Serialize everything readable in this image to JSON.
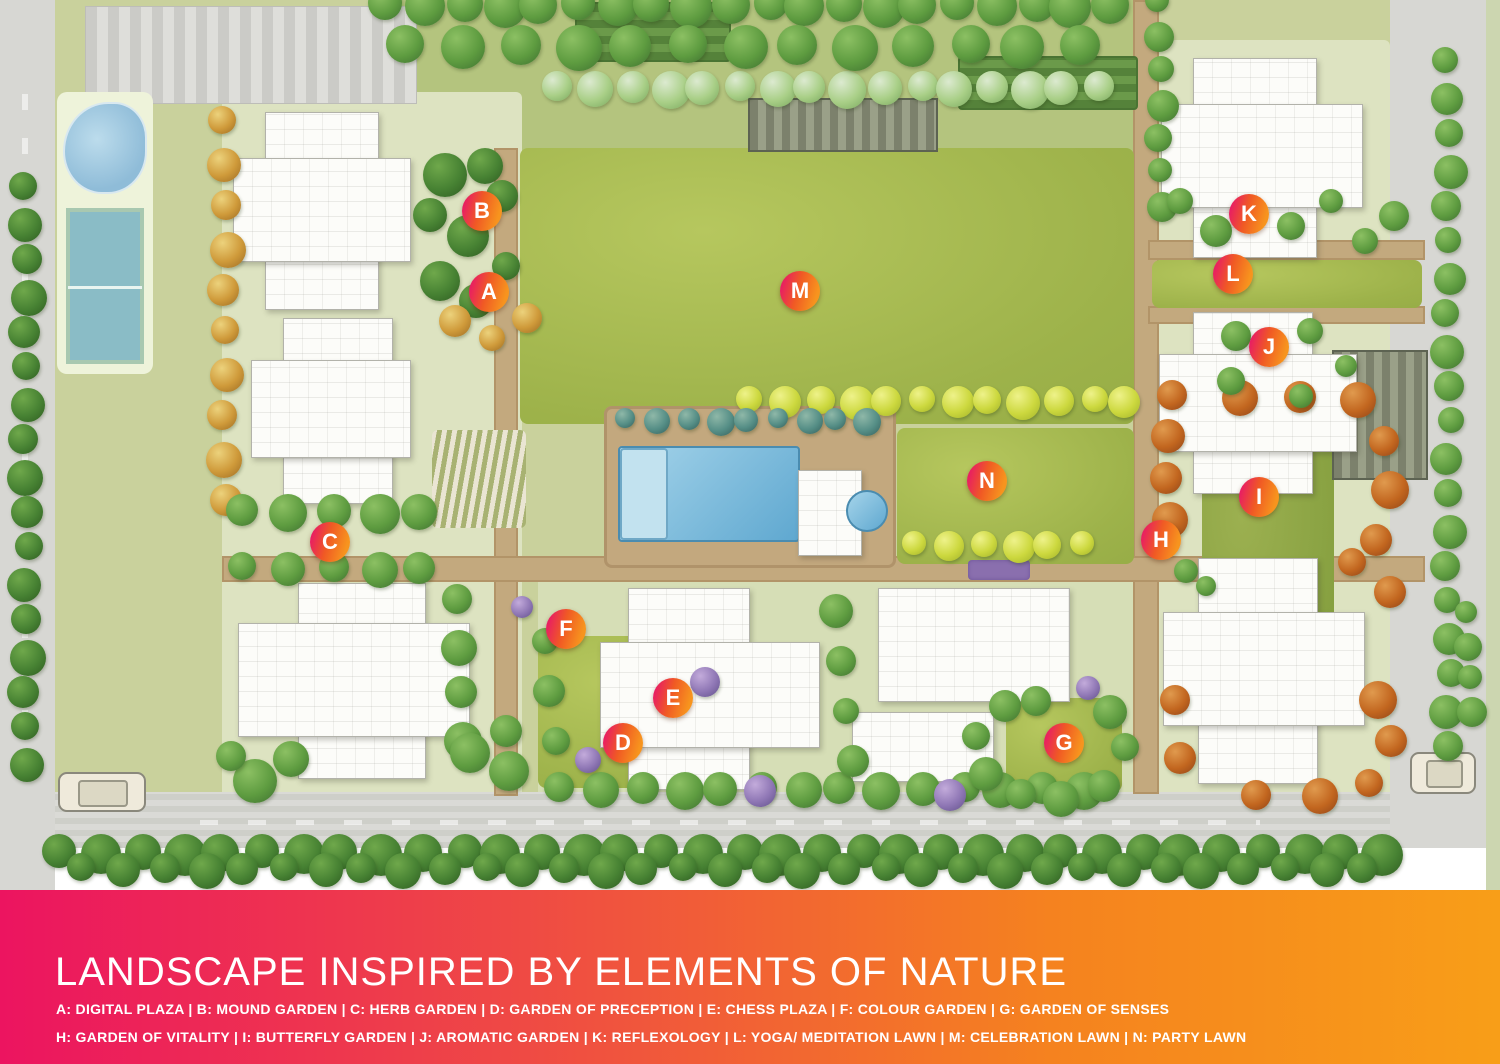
{
  "banner": {
    "title": "LANDSCAPE INSPIRED BY ELEMENTS OF NATURE",
    "legend_line_1": "A: DIGITAL PLAZA | B: MOUND GARDEN | C: HERB GARDEN | D: GARDEN OF PRECEPTION | E: CHESS PLAZA | F: COLOUR GARDEN | G: GARDEN OF SENSES",
    "legend_line_2": "H: GARDEN OF VITALITY | I: BUTTERFLY GARDEN | J: AROMATIC GARDEN | K: REFLEXOLOGY | L: YOGA/ MEDITATION LAWN | M: CELEBRATION LAWN | N: PARTY LAWN",
    "gradient_left": "#ec1460",
    "gradient_mid_1": "#ef4a44",
    "gradient_mid_2": "#f5821f",
    "gradient_right": "#f89e18",
    "text_color": "#ffffff"
  },
  "marker_style": {
    "gradient_start": "#e81e63",
    "gradient_mid": "#f05a24",
    "gradient_end": "#f7941e",
    "text_color": "#ffffff"
  },
  "markers": [
    {
      "letter": "A",
      "name": "DIGITAL PLAZA",
      "x": 489,
      "y": 292
    },
    {
      "letter": "B",
      "name": "MOUND GARDEN",
      "x": 482,
      "y": 211
    },
    {
      "letter": "C",
      "name": "HERB GARDEN",
      "x": 330,
      "y": 542
    },
    {
      "letter": "D",
      "name": "GARDEN OF PRECEPTION",
      "x": 623,
      "y": 743
    },
    {
      "letter": "E",
      "name": "CHESS PLAZA",
      "x": 673,
      "y": 698
    },
    {
      "letter": "F",
      "name": "COLOUR GARDEN",
      "x": 566,
      "y": 629
    },
    {
      "letter": "G",
      "name": "GARDEN OF SENSES",
      "x": 1064,
      "y": 743
    },
    {
      "letter": "H",
      "name": "GARDEN OF VITALITY",
      "x": 1161,
      "y": 540
    },
    {
      "letter": "I",
      "name": "BUTTERFLY GARDEN",
      "x": 1259,
      "y": 497
    },
    {
      "letter": "J",
      "name": "AROMATIC GARDEN",
      "x": 1269,
      "y": 347
    },
    {
      "letter": "K",
      "name": "REFLEXOLOGY",
      "x": 1249,
      "y": 214
    },
    {
      "letter": "L",
      "name": "YOGA/ MEDITATION LAWN",
      "x": 1233,
      "y": 274
    },
    {
      "letter": "M",
      "name": "CELEBRATION LAWN",
      "x": 800,
      "y": 291
    },
    {
      "letter": "N",
      "name": "PARTY LAWN",
      "x": 987,
      "y": 481
    }
  ]
}
